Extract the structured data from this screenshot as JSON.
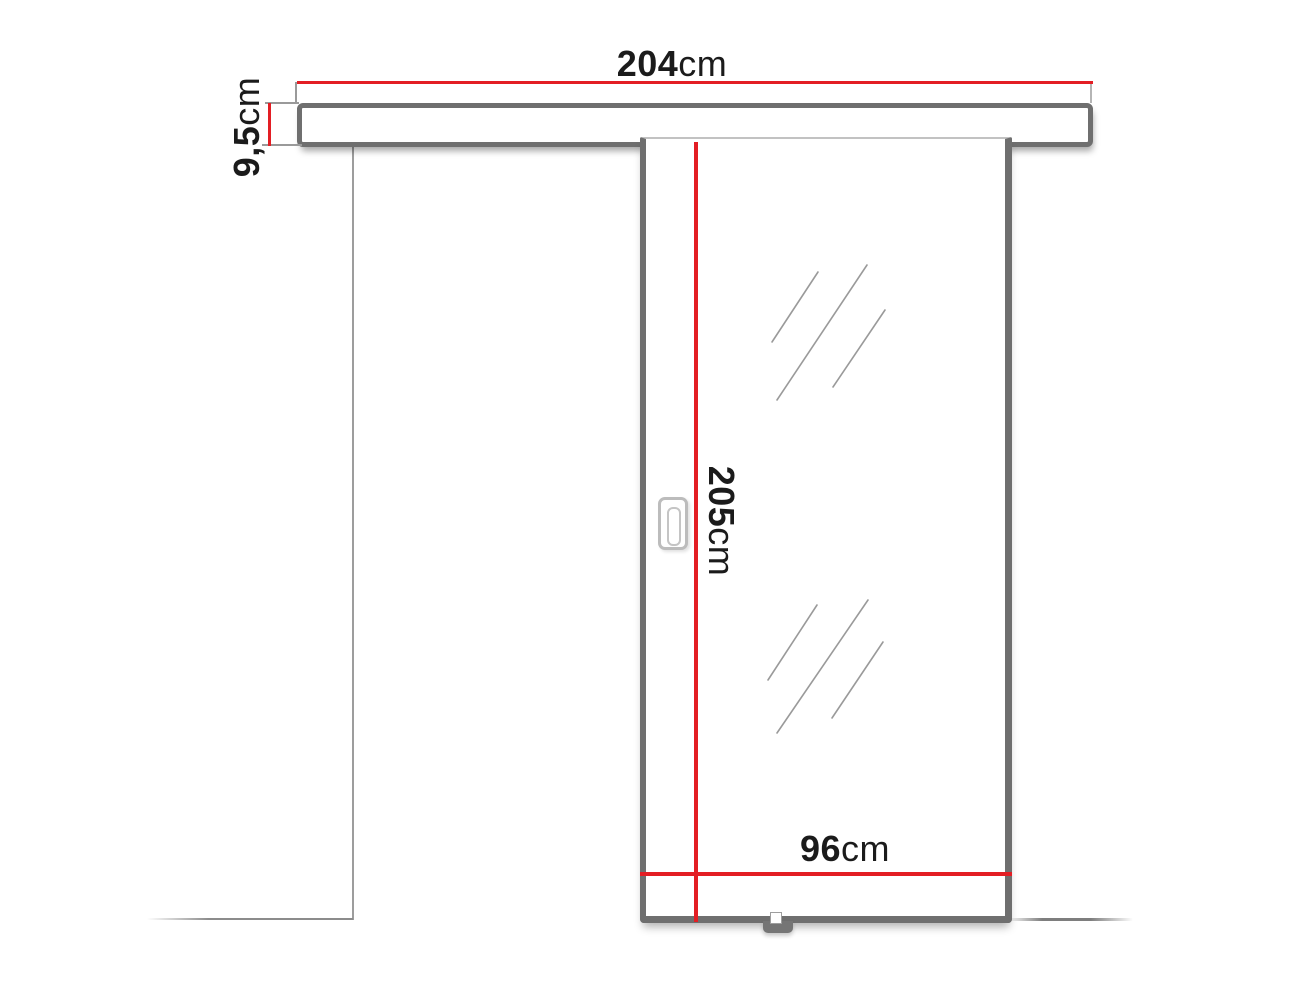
{
  "diagram": {
    "title": "sliding door dimension drawing",
    "dimensions": {
      "rail_width": {
        "value": "204",
        "unit": "cm"
      },
      "rail_height": {
        "value": "9,5",
        "unit": "cm"
      },
      "door_height": {
        "value": "205",
        "unit": "cm"
      },
      "door_width": {
        "value": "96",
        "unit": "cm"
      }
    },
    "colors": {
      "dimension_red": "#e31e24",
      "frame_gray": "#6f6f6f",
      "thin_line_gray": "#9a9a9a",
      "text_dark": "#1b1b1b",
      "background": "#ffffff"
    }
  }
}
